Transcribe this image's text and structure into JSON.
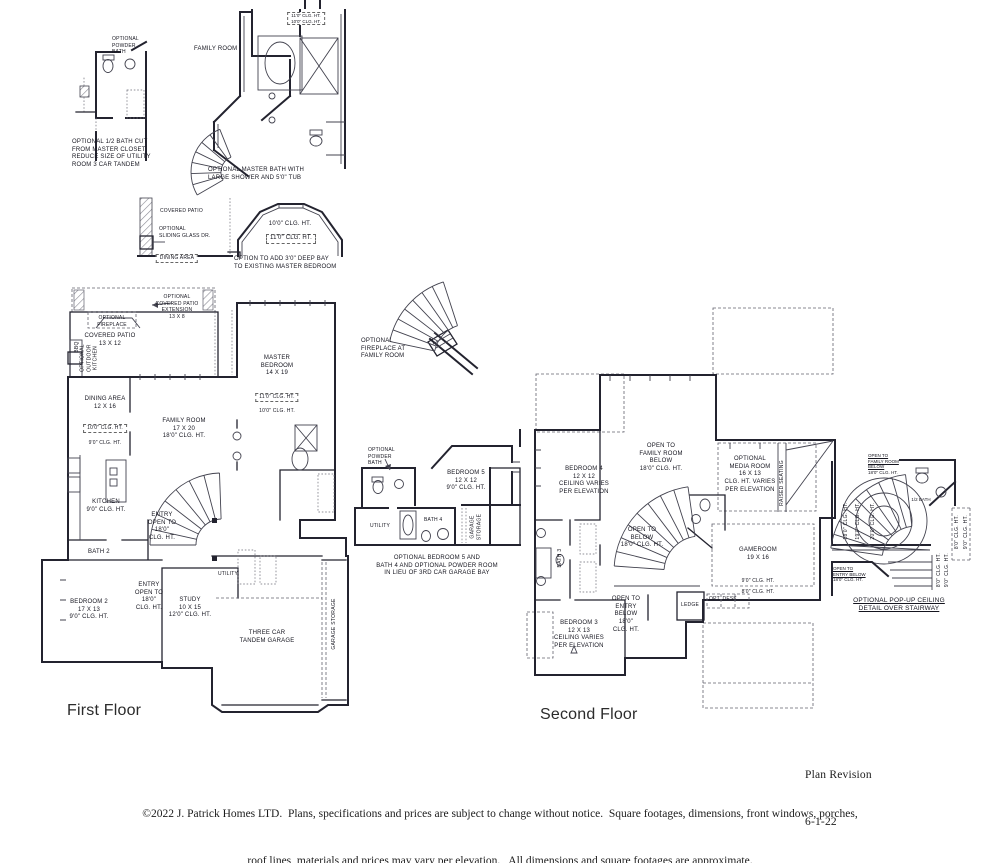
{
  "page": {
    "first_floor_title": "First Floor",
    "second_floor_title": "Second Floor",
    "revision": [
      "Plan Revision",
      "6-1-22"
    ],
    "copyright": [
      "©2022 J. Patrick Homes LTD.  Plans, specifications and prices are subject to change without notice.  Square footages, dimensions, front windows, porches,",
      "roof lines, materials and prices may vary per elevation.   All dimensions and square footages are approximate."
    ]
  },
  "insets": {
    "half_bath": {
      "powder": [
        "OPTIONAL",
        "POWDER",
        "BATH"
      ],
      "caption": [
        "OPTIONAL 1/2 BATH CUT",
        "FROM MASTER CLOSET",
        "REDUCE SIZE OF UTILITY",
        "ROOM 3 CAR TANDEM"
      ]
    },
    "master_bath": {
      "family_room": "FAMILY ROOM",
      "clg": [
        "11'0\" CLG. HT.",
        "10'0\" CLG. HT."
      ],
      "caption": [
        "OPTIONAL MASTER BATH WITH",
        "LARGE SHOWER AND 5'0\" TUB"
      ]
    },
    "patio": {
      "covered_patio": "COVERED PATIO",
      "sliding": [
        "OPTIONAL",
        "SLIDING GLASS DR."
      ],
      "dining": "DINING AREA"
    },
    "bay": {
      "clg1": "10'0\" CLG. HT.",
      "clg2": "11'0\" CLG. HT.",
      "caption": [
        "OPTION TO ADD  3'0\"  DEEP BAY",
        "TO EXISTING MASTER BEDROOM"
      ]
    },
    "fireplace": {
      "caption": [
        "OPTIONAL",
        "FIREPLACE AT",
        "FAMILY ROOM"
      ]
    },
    "bedroom5": {
      "powder": [
        "OPTIONAL",
        "POWDER",
        "BATH"
      ],
      "bedroom": [
        "BEDROOM 5",
        "12 X 12",
        "9'0\" CLG. HT."
      ],
      "utility": "UTILITY",
      "bath4": "BATH 4",
      "storage": [
        "GARAGE",
        "STORAGE"
      ],
      "caption": [
        "OPTIONAL BEDROOM 5 AND",
        "BATH 4 AND OPTIONAL POWDER ROOM",
        "IN LIEU OF 3RD CAR GARAGE BAY"
      ]
    },
    "popup": {
      "header": [
        "OPEN TO",
        "FAMILY ROOM",
        "BELOW",
        "18'0\" CLG. HT."
      ],
      "half_bath": "1/2 BATH",
      "rings": [
        "18'0\" CLG. HT.",
        "19'0\" CLG. HT.",
        "20'0\" CLG. HT."
      ],
      "side1": "8'0\" CLG. HT.",
      "side2": "9'0\" CLG. HT.",
      "open_entry": [
        "OPEN TO",
        "ENTRY BELOW"
      ],
      "entry_clg": "18'0\" CLG. HT.",
      "title": [
        "OPTIONAL POP-UP CEILING",
        "DETAIL OVER STAIRWAY"
      ]
    }
  },
  "first_floor": {
    "patio_ext": [
      "OPTIONAL",
      "COVERED PATIO",
      "EXTENSION",
      "13 X 8"
    ],
    "fireplace": [
      "OPTIONAL",
      "FIREPLACE"
    ],
    "covered_patio": [
      "COVERED PATIO",
      "13 X 12"
    ],
    "bbq": "BBQ",
    "outdoor_kitchen": [
      "OPTIONAL",
      "OUTDOOR",
      "KITCHEN"
    ],
    "dining": [
      "DINING AREA",
      "12 X 16"
    ],
    "dining_clg1": "10'0\" CLG. HT.",
    "dining_clg2": "9'0\" CLG. HT.",
    "family": [
      "FAMILY ROOM",
      "17 X 20",
      "18'0\" CLG. HT."
    ],
    "master": [
      "MASTER",
      "BEDROOM",
      "14 X 19"
    ],
    "master_clg1": "11'0\" CLG. HT.",
    "master_clg2": "10'0\" CLG. HT.",
    "kitchen": [
      "KITCHEN",
      "9'0\" CLG. HT."
    ],
    "entry1": [
      "ENTRY",
      "OPEN TO",
      "18'0\"",
      "CLG. HT."
    ],
    "bath2": "BATH 2",
    "entry2": [
      "ENTRY",
      "OPEN TO",
      "18'0\"",
      "CLG. HT."
    ],
    "bedroom2": [
      "BEDROOM 2",
      "17 X 13",
      "9'0\" CLG. HT."
    ],
    "study": [
      "STUDY",
      "10 X 15",
      "12'0\" CLG. HT."
    ],
    "utility": "UTILITY",
    "garage": [
      "THREE CAR",
      "TANDEM GARAGE"
    ],
    "garage_storage": "GARAGE STORAGE"
  },
  "second_floor": {
    "open_family": [
      "OPEN TO",
      "FAMILY ROOM",
      "BELOW",
      "18'0\" CLG. HT."
    ],
    "bedroom4": [
      "BEDROOM 4",
      "12 X 12",
      "CEILING VARIES",
      "PER ELEVATION"
    ],
    "media": [
      "OPTIONAL",
      "MEDIA ROOM",
      "16 X 13",
      "CLG. HT. VARIES",
      "PER ELEVATION"
    ],
    "raised_seating": "RAISED SEATING",
    "open_below": [
      "OPEN TO",
      "BELOW",
      "18'0\" CLG. HT."
    ],
    "bath3": "BATH 3",
    "gameroom": [
      "GAMEROOM",
      "19 X 16"
    ],
    "gameroom_clg1": "9'0\" CLG. HT.",
    "gameroom_clg2": "8'0\" CLG. HT.",
    "open_entry": [
      "OPEN TO",
      "ENTRY",
      "BELOW",
      "18'0\"",
      "CLG. HT."
    ],
    "ledge": "LEDGE",
    "opt_desk": "OPT. DESK",
    "bedroom3": [
      "BEDROOM 3",
      "12 X 13",
      "CEILING VARIES",
      "PER ELEVATION"
    ]
  }
}
